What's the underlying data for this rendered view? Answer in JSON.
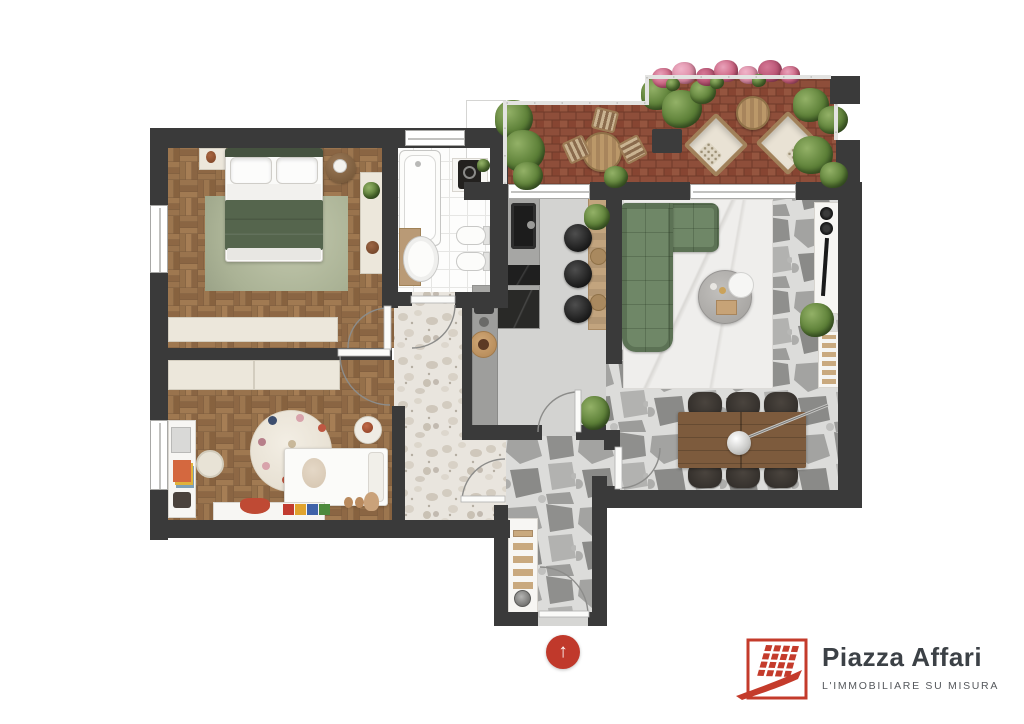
{
  "branding": {
    "logo_text": "Piazza Affari",
    "tagline": "L'IMMOBILIARE SU MISURA",
    "logo_red": "#c43b2b",
    "title_color": "#3c4146",
    "tagline_color": "#55585c",
    "icon": "building-grid-icon"
  },
  "entrance_marker": {
    "glyph": "↑",
    "color": "#c0392b",
    "icon": "up-arrow-icon"
  },
  "colors": {
    "wall": "#3a3a3a",
    "parquet": "#916c49",
    "bath_tile": "#fdfdfc",
    "kitchen_concrete": "#d3d3d1",
    "flagstone": "#a3a3a1",
    "terrazzo": "#e9e5de",
    "terracotta": "#8e4e3a",
    "sofa_green": "#6f8767",
    "duvet_green": "#55654d",
    "bedroom_rug": "#b5bca3",
    "wood": "#8b6a4c"
  },
  "floorplan": {
    "rooms": [
      {
        "name": "master-bedroom",
        "floor": "parquet"
      },
      {
        "name": "kids-bedroom",
        "floor": "parquet"
      },
      {
        "name": "bathroom",
        "floor": "white-tile"
      },
      {
        "name": "kitchen",
        "floor": "concrete"
      },
      {
        "name": "living-dining-room",
        "floor": "flagstone"
      },
      {
        "name": "hallway",
        "floor": "terrazzo"
      },
      {
        "name": "entry-corridor",
        "floor": "flagstone"
      },
      {
        "name": "terrace",
        "floor": "terracotta-brick"
      }
    ],
    "furniture": {
      "master_bedroom": [
        "double-bed",
        "area-rug",
        "nightstand",
        "round-side-table",
        "wardrobe",
        "dresser"
      ],
      "kids_bedroom": [
        "wardrobe",
        "desk",
        "chair",
        "polka-dot-rug",
        "kids-bed",
        "side-table",
        "toys"
      ],
      "bathroom": [
        "bathtub",
        "washbasin",
        "vanity-mirror",
        "toilet",
        "bidet"
      ],
      "kitchen": [
        "counter-with-sink",
        "cooktop",
        "breakfast-bar",
        "bar-stools"
      ],
      "living_dining": [
        "corner-sofa",
        "coffee-table",
        "tv-console",
        "speakers",
        "dining-table",
        "six-chairs",
        "pendant-lamp",
        "bench"
      ],
      "terrace": [
        "round-table",
        "chairs",
        "lounge-chairs",
        "coffee-table",
        "planter",
        "plants",
        "flowers"
      ],
      "entry": [
        "shoe-rack"
      ]
    }
  }
}
